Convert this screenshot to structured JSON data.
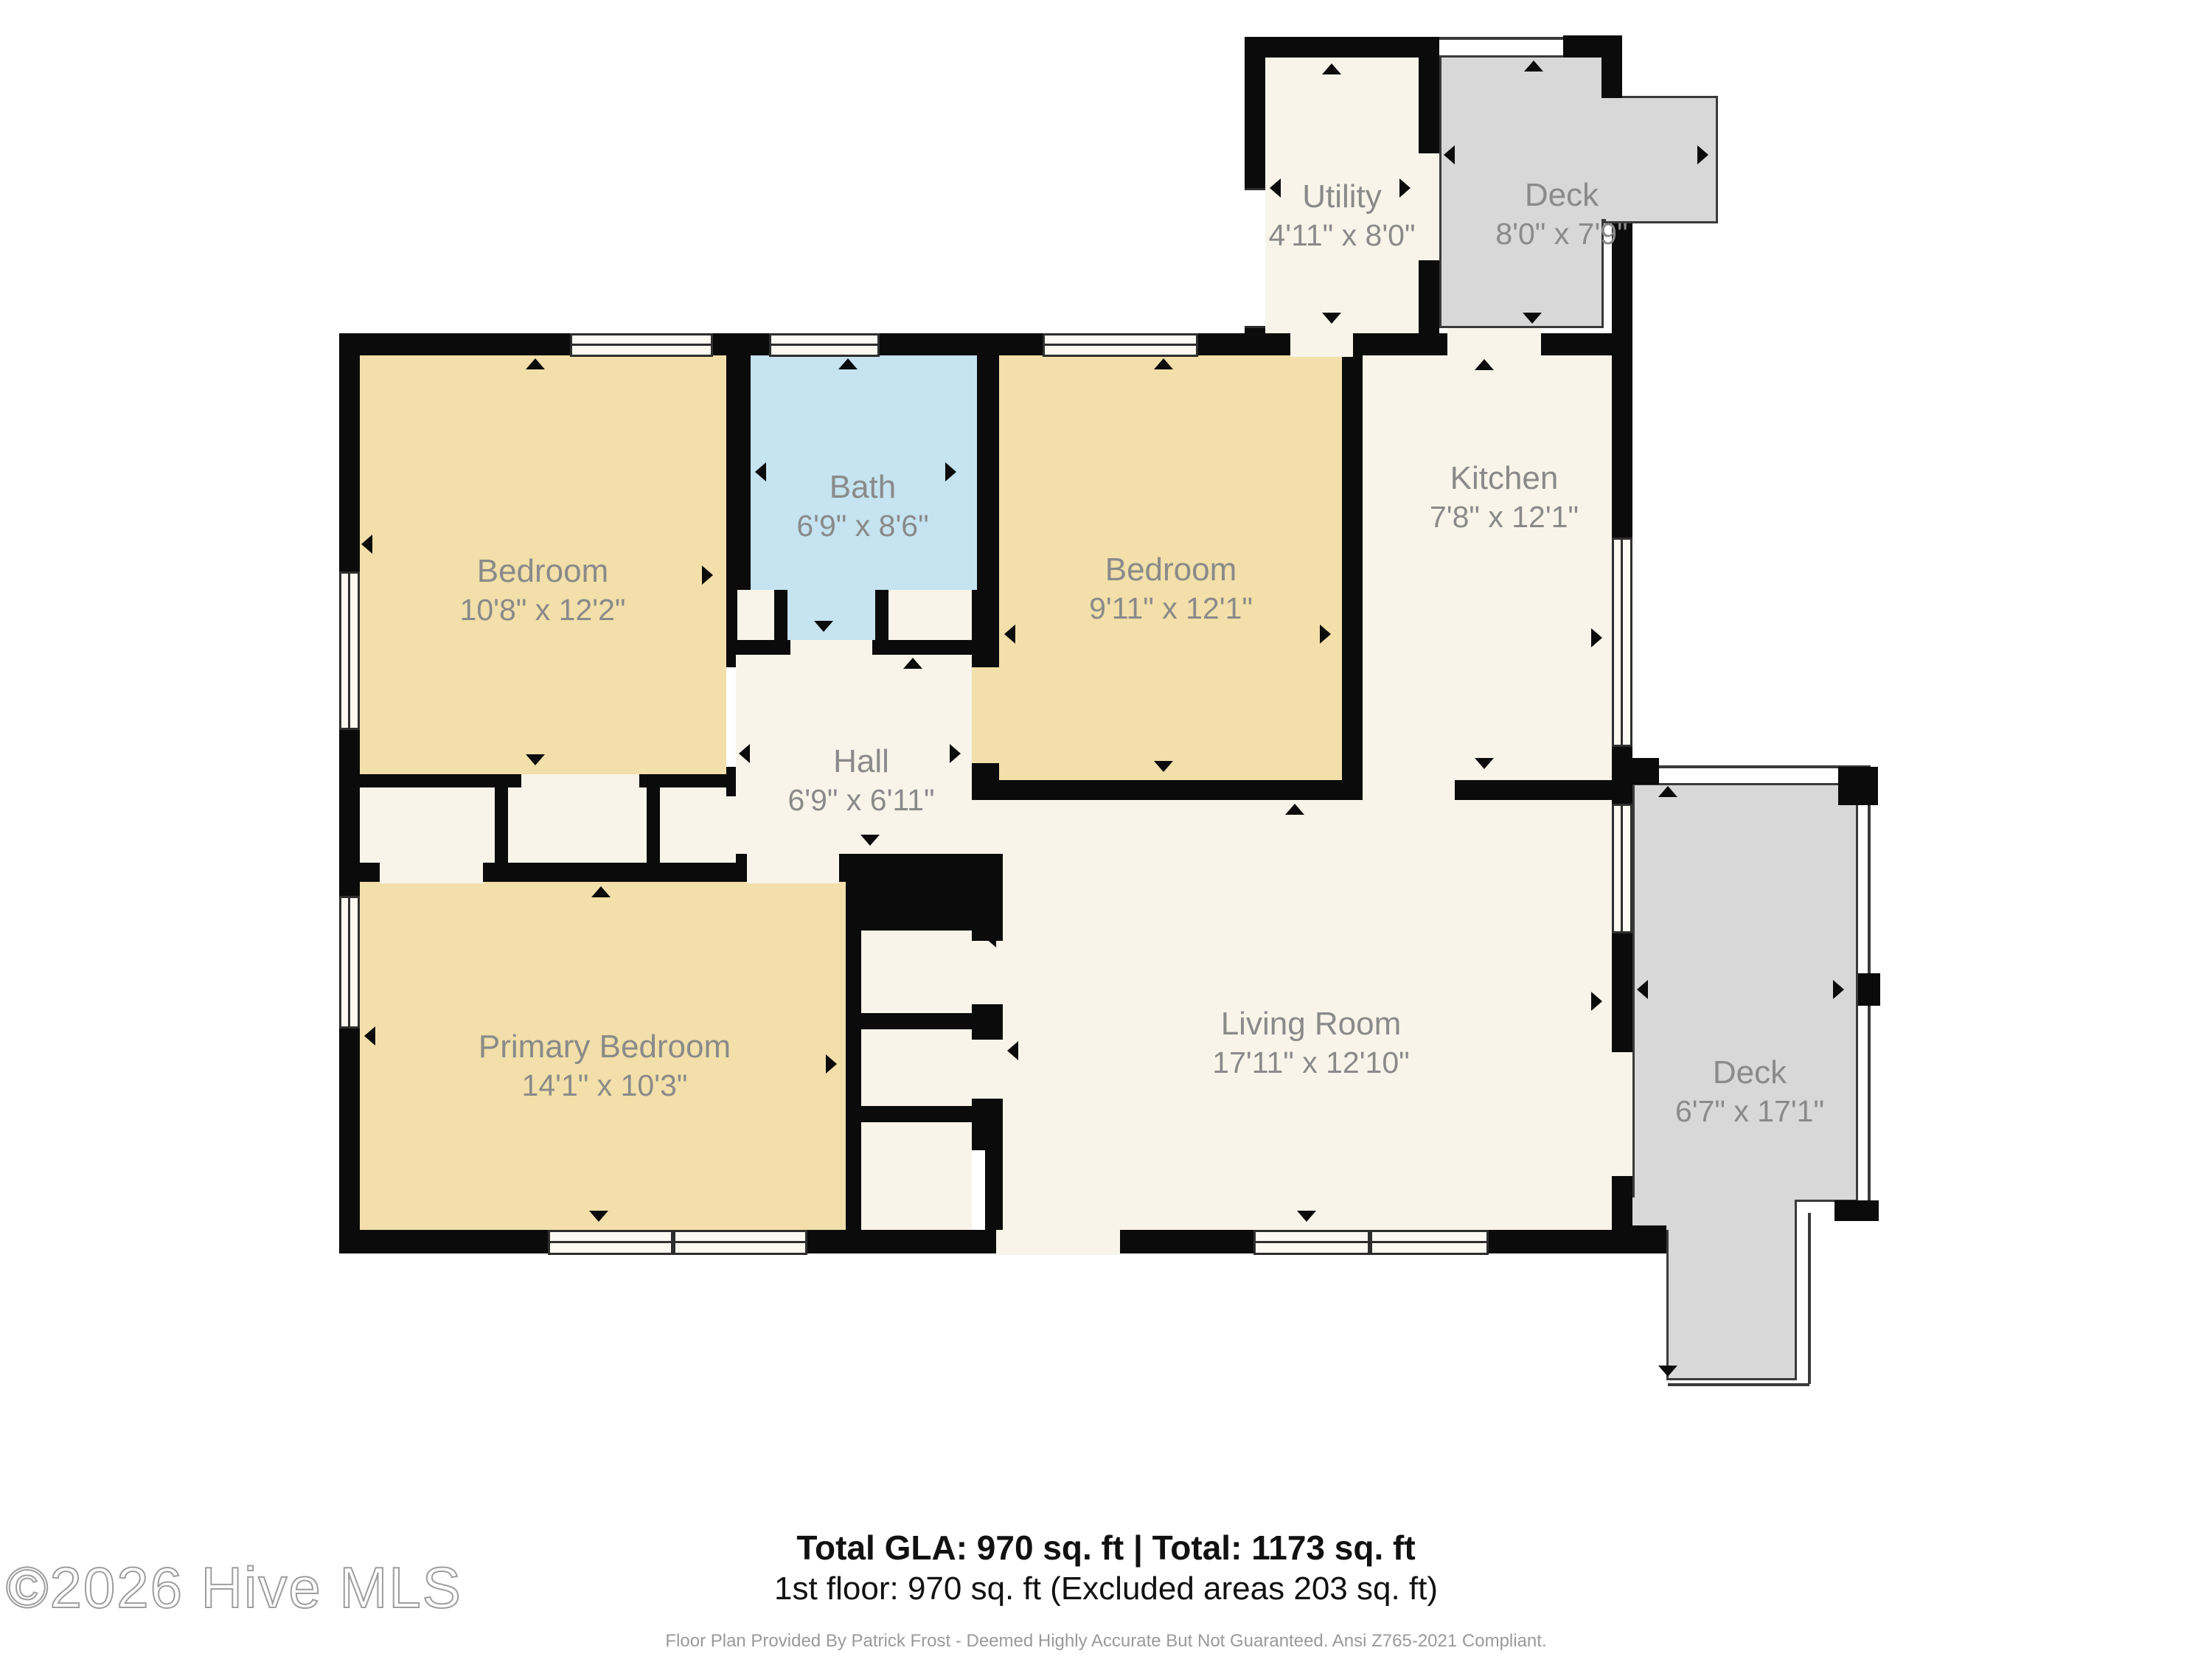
{
  "rooms": [
    {
      "id": "utility",
      "name": "Utility",
      "dims": "4'11\" x 8'0\""
    },
    {
      "id": "deck-top",
      "name": "Deck",
      "dims": "8'0\" x 7'9\""
    },
    {
      "id": "bedroom-1",
      "name": "Bedroom",
      "dims": "10'8\" x 12'2\""
    },
    {
      "id": "bath",
      "name": "Bath",
      "dims": "6'9\" x 8'6\""
    },
    {
      "id": "bedroom-2",
      "name": "Bedroom",
      "dims": "9'11\" x 12'1\""
    },
    {
      "id": "kitchen",
      "name": "Kitchen",
      "dims": "7'8\" x 12'1\""
    },
    {
      "id": "hall",
      "name": "Hall",
      "dims": "6'9\" x 6'11\""
    },
    {
      "id": "primary-bedroom",
      "name": "Primary Bedroom",
      "dims": "14'1\" x 10'3\""
    },
    {
      "id": "living-room",
      "name": "Living Room",
      "dims": "17'11\" x 12'10\""
    },
    {
      "id": "deck-right",
      "name": "Deck",
      "dims": "6'7\" x 17'1\""
    }
  ],
  "footer": {
    "summary": "Total GLA: 970 sq. ft | Total: 1173 sq. ft",
    "floor_line": "1st floor: 970 sq. ft (Excluded areas 203 sq. ft)",
    "disclaimer": "Floor Plan Provided By Patrick Frost - Deemed Highly Accurate But Not Guaranteed. Ansi Z765-2021 Compliant."
  },
  "watermark": "©2026 Hive MLS",
  "colors": {
    "wall": "#0b0b0b",
    "room": "#f8f4e9",
    "bedroom": "#f2dfa9",
    "bath": "#c5e3f0",
    "deck": "#d8d8d8",
    "deck-line": "#3a3a3a",
    "label": "#8a8a8a",
    "ink": "#111111",
    "muted": "#9a9a9a"
  }
}
